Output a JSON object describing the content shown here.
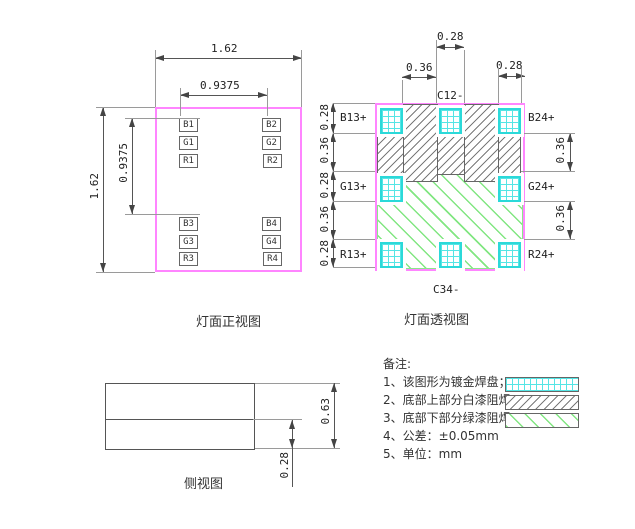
{
  "front_view": {
    "title": "灯面正视图",
    "dim_width": "1.62",
    "dim_height": "1.62",
    "dim_pitch_x": "0.9375",
    "dim_pitch_y": "0.9375",
    "pads": [
      "B1",
      "G1",
      "R1",
      "B2",
      "G2",
      "R2",
      "B3",
      "G3",
      "R3",
      "B4",
      "G4",
      "R4"
    ]
  },
  "perspective_view": {
    "title": "灯面透视图",
    "dim_top_gap": "0.36",
    "dim_top_pad": "0.28",
    "dim_top_right_pad": "0.28",
    "left_dims": [
      "0.28",
      "0.36",
      "0.28",
      "0.36",
      "0.28"
    ],
    "right_dims": [
      "0.36",
      "0.36"
    ],
    "label_top_center": "C12-",
    "label_bottom_center": "C34-",
    "left_labels": [
      "B13+",
      "G13+",
      "R13+"
    ],
    "right_labels": [
      "B24+",
      "G24+",
      "R24+"
    ]
  },
  "side_view": {
    "title": "侧视图",
    "dim_total_height": "0.63",
    "dim_lower_height": "0.28"
  },
  "notes": {
    "heading": "备注:",
    "items": [
      "1、该图形为镀金焊盘；",
      "2、底部上部分白漆阻焊；",
      "3、底部下部分绿漆阻焊；",
      "4、公差：±0.05mm",
      "5、单位：mm"
    ]
  },
  "legend": {
    "gold_pad_swatch": "cyan-grid",
    "white_mask_swatch": "gray-diagonal-hatch",
    "green_mask_swatch": "green-diagonal-hatch"
  },
  "colors": {
    "outline": "#ff85ff",
    "pad_grid": "#2bd9d9",
    "white_mask_hatch": "#7a7a7a",
    "green_mask_hatch": "#82e682",
    "dimension": "#555555"
  }
}
